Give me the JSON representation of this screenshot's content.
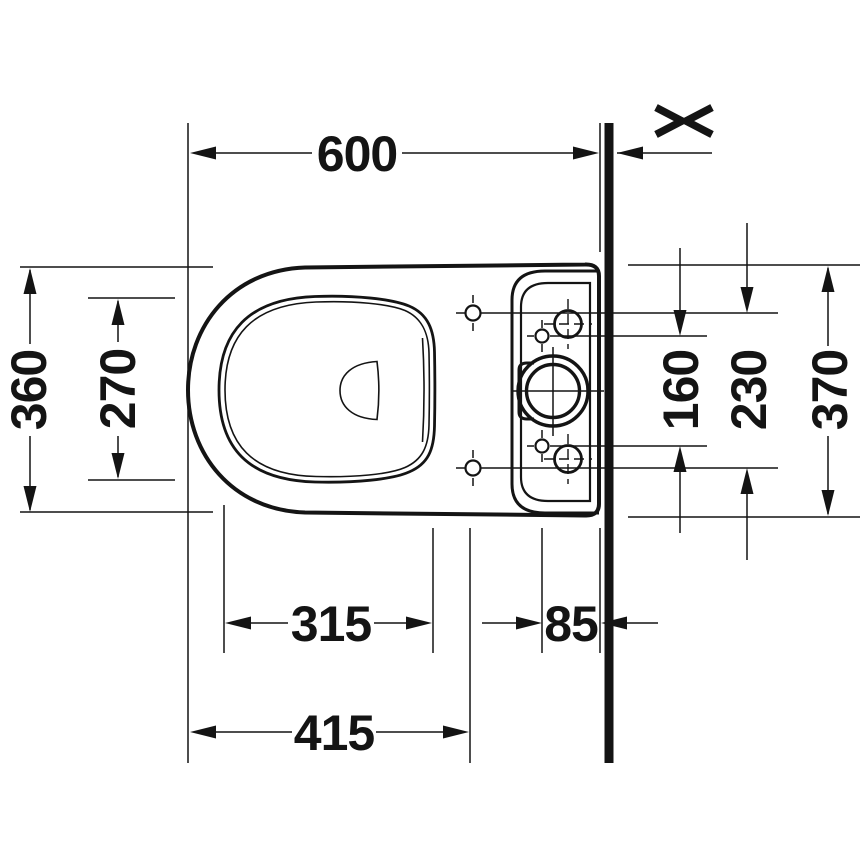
{
  "drawing": {
    "type": "technical-dimension-drawing",
    "subject": "floor-standing close-coupled toilet, top view, against wall",
    "units": "mm",
    "wall": {
      "present": true,
      "break_symbol": "><"
    },
    "dimensions": {
      "front_to_wall": {
        "value": "600",
        "orientation": "horizontal",
        "meaning": "front edge of bowl to wall"
      },
      "bowl_width": {
        "value": "360",
        "orientation": "vertical",
        "meaning": "overall bowl width"
      },
      "seat_opening_width": {
        "value": "270",
        "orientation": "vertical",
        "meaning": "inner seat opening width"
      },
      "supply_holes_spacing": {
        "value": "160",
        "orientation": "vertical",
        "meaning": "spacing of small fixing holes on cistern"
      },
      "seat_holes_spacing": {
        "value": "230",
        "orientation": "vertical",
        "meaning": "spacing of seat fixing holes"
      },
      "tank_width": {
        "value": "370",
        "orientation": "vertical",
        "meaning": "overall cistern width at wall"
      },
      "seat_opening_length": {
        "value": "315",
        "orientation": "horizontal",
        "meaning": "inner seat opening length"
      },
      "holes_to_rear": {
        "value": "85",
        "orientation": "horizontal",
        "meaning": "fixing holes to rear edge / wall"
      },
      "front_to_seat_holes": {
        "value": "415",
        "orientation": "horizontal",
        "meaning": "front edge to seat fixing hole axis"
      }
    }
  }
}
